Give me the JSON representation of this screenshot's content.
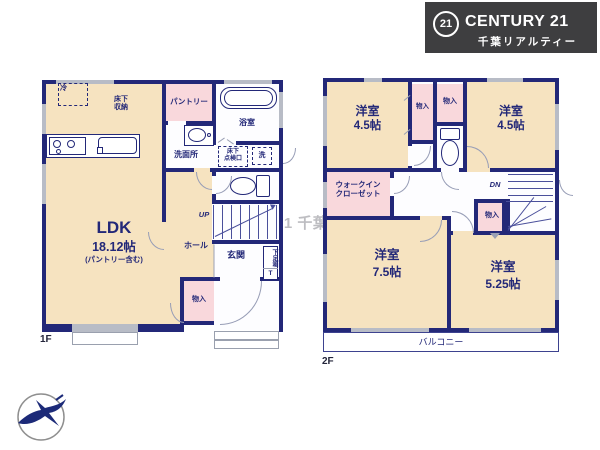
{
  "brand": {
    "seal": "21",
    "name": "CENTURY 21",
    "sub": "千葉リアルティー"
  },
  "watermark": "センチュリー21 千葉リアルティー",
  "f1": {
    "label": "1F",
    "fridge": "冷",
    "floor_storage": "床下\n収納",
    "pantry": "パントリー",
    "bath": "浴室",
    "washroom": "洗面所",
    "hatch": "床下\n点検口",
    "laundry": "洗",
    "ldk": "LDK",
    "ldk_size": "18.12帖",
    "ldk_note": "(パントリー含む)",
    "hall": "ホール",
    "up": "UP",
    "entry": "玄関",
    "shoe_box": "下足箱",
    "shoe_t": "T",
    "closet": "物入"
  },
  "f2": {
    "label": "2F",
    "rooms": [
      {
        "name": "洋室",
        "size": "4.5帖"
      },
      {
        "name": "洋室",
        "size": "4.5帖"
      },
      {
        "name": "洋室",
        "size": "7.5帖"
      },
      {
        "name": "洋室",
        "size": "5.25帖"
      }
    ],
    "closets": [
      "物入",
      "物入",
      "物入"
    ],
    "wic": "ウォークイン\nクローゼット",
    "dn": "DN",
    "balcony": "バルコニー"
  },
  "colors": {
    "wall": "#232878",
    "room_cream": "#f6e3c0",
    "room_pink": "#f9d8dc",
    "logo_bg": "#3e3e40"
  }
}
